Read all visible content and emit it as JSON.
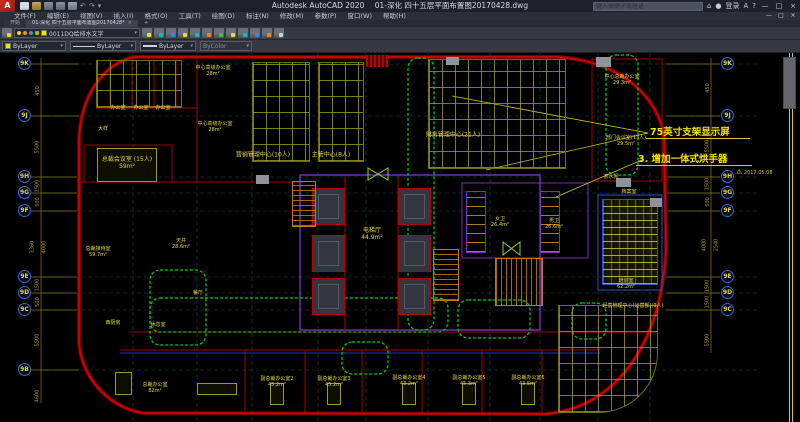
{
  "window": {
    "app_title": "Autodesk AutoCAD 2020",
    "doc_title": "01-深化 四十五层平面布置图20170428.dwg",
    "search_placeholder": "键入关键字或短语",
    "sign_in": "登录"
  },
  "icons": {
    "minimize": "—",
    "maximize": "□",
    "close": "×",
    "dropdown": "▾",
    "undo": "↶",
    "redo": "↷",
    "plus": "+",
    "help": "?",
    "autodesk_a": "A",
    "warning": "⚠",
    "app_logo": "A"
  },
  "menu": {
    "items": [
      "文件(F)",
      "编辑(E)",
      "视图(V)",
      "插入(I)",
      "格式(O)",
      "工具(T)",
      "绘图(D)",
      "标注(N)",
      "修改(M)",
      "参数(P)",
      "窗口(W)",
      "帮助(H)"
    ]
  },
  "tabs": {
    "start": "开始",
    "drawing": "01-深化 四十五层平面布置图20170428*"
  },
  "toolbar": {
    "layer_name": "0011DQ给排水文字",
    "color": "ByLayer",
    "linetype": "ByLayer",
    "lineweight": "ByLayer",
    "plot_style": "ByColor"
  },
  "annotations": {
    "note1": "75英寸支架显示屏",
    "note2": "3. 增加一体式烘手器",
    "date": "2017.05.08"
  },
  "axes": {
    "left": [
      "9K",
      "9J",
      "9H",
      "9G",
      "9F",
      "9E",
      "9D",
      "9C",
      "9B"
    ],
    "right": [
      "9K",
      "9J",
      "9H",
      "9G",
      "9F",
      "9E",
      "9D",
      "9C"
    ]
  },
  "dims": {
    "left": [
      "450",
      "5500",
      "1500",
      "500",
      "3360",
      "4000",
      "1500",
      "500",
      "5500",
      "4600"
    ],
    "right": [
      "450",
      "5500",
      "1500",
      "500",
      "4000",
      "2540",
      "1500",
      "1500",
      "5500"
    ]
  },
  "rooms": [
    {
      "label": "总裁会议室 (15人)\n59m²"
    },
    {
      "label": "办公室"
    },
    {
      "label": "办公室"
    },
    {
      "label": "办公室"
    },
    {
      "label": "中心高级办公室\n28m²"
    },
    {
      "label": "中心高级办公室\n28m²"
    },
    {
      "label": "营销管理中心(10人)"
    },
    {
      "label": "主管中心(8人)"
    },
    {
      "label": "财务管理中心(21人)"
    },
    {
      "label": "中心总裁办公室\n29.3m²"
    },
    {
      "label": "部门会议室(13人)\n29.5m²"
    },
    {
      "label": "茶水间"
    },
    {
      "label": "档案室"
    },
    {
      "label": "电梯厅\n44.9m²"
    },
    {
      "label": "女卫\n26.4m²"
    },
    {
      "label": "男卫\n26.6m²"
    },
    {
      "label": "天井\n28.6m²"
    },
    {
      "label": "总裁接待室\n59.7m²"
    },
    {
      "label": "休息室"
    },
    {
      "label": "餐厅"
    },
    {
      "label": "西厨房"
    },
    {
      "label": "总裁办公室\n82m²"
    },
    {
      "label": "副总裁办公室2\n45.2m²"
    },
    {
      "label": "副总裁办公室3\n45.2m²"
    },
    {
      "label": "副总裁办公室4\n43.2m²"
    },
    {
      "label": "副总裁办公室5\n45.3m²"
    },
    {
      "label": "副总裁办公室6\n43.5m²"
    },
    {
      "label": "培训室\n62.2m²"
    },
    {
      "label": "经营管理中心(运营部)(9人)"
    },
    {
      "label": "大样"
    }
  ],
  "colors": {
    "outline_red": "#c40000",
    "wall_purple": "#7a30c0",
    "cloud_green": "#00cc00",
    "label_yellow": "#e8d840",
    "grid_teal": "#0a4f4f",
    "stair_orange": "#c87800"
  }
}
